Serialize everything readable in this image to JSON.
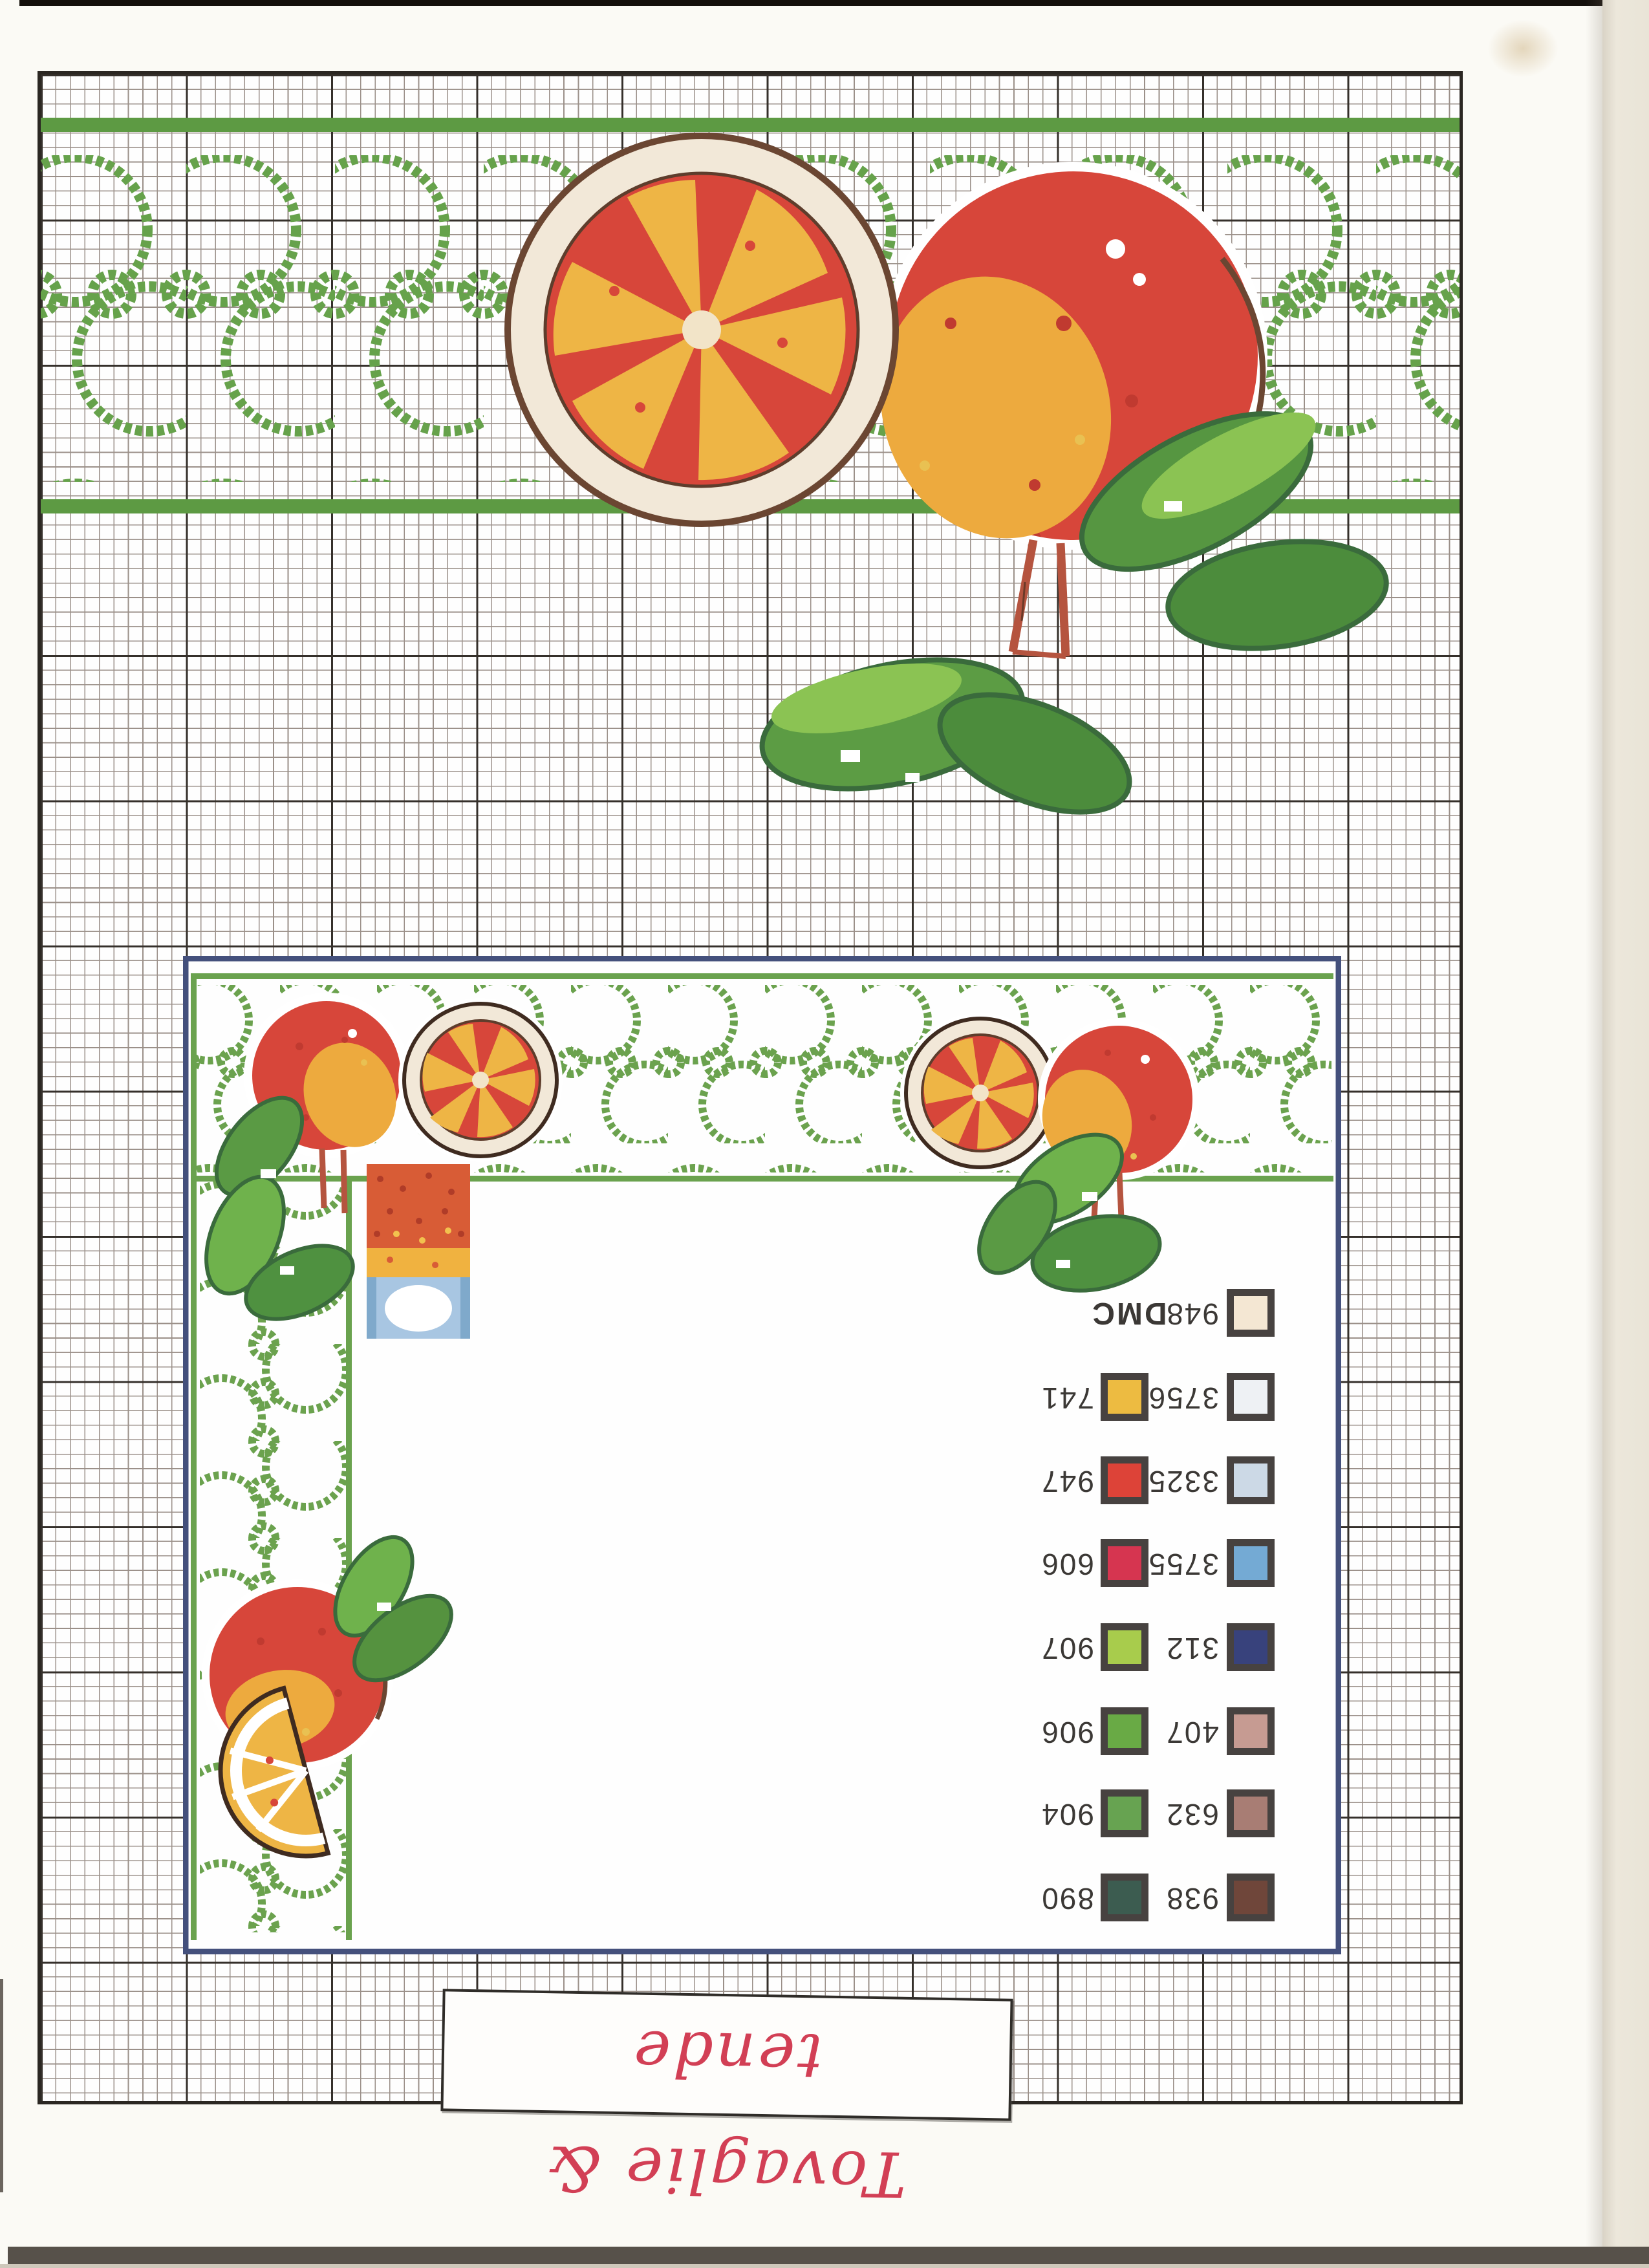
{
  "page": {
    "title": "Tovaglie & tende"
  },
  "legend": {
    "header": "DMC",
    "rows": [
      {
        "left_code": "",
        "left_color": "",
        "right_code": "948",
        "right_color": "#f4e7d3"
      },
      {
        "left_code": "741",
        "left_color": "#edbb41",
        "right_code": "3756",
        "right_color": "#eef1f4"
      },
      {
        "left_code": "947",
        "left_color": "#dd4338",
        "right_code": "3325",
        "right_color": "#ccd9e6"
      },
      {
        "left_code": "606",
        "left_color": "#d63550",
        "right_code": "3755",
        "right_color": "#74aad4"
      },
      {
        "left_code": "907",
        "left_color": "#a8cc4c",
        "right_code": "312",
        "right_color": "#38427c"
      },
      {
        "left_code": "906",
        "left_color": "#69aa45",
        "right_code": "407",
        "right_color": "#c69b92"
      },
      {
        "left_code": "904",
        "left_color": "#67a351",
        "right_code": "632",
        "right_color": "#a87d74"
      },
      {
        "left_code": "890",
        "left_color": "#3c5c50",
        "right_code": "938",
        "right_color": "#6f463a"
      }
    ]
  },
  "colors": {
    "lattice_green": "#66a24b",
    "band_green": "#5d9a43",
    "orange_red": "#d7463a",
    "orange_yellow": "#edaa3e",
    "slice_yellow": "#eeb545",
    "rind_cream": "#f2e8d8",
    "outline_brown": "#6b4632",
    "leaf_mid": "#569641",
    "leaf_light": "#8bc353",
    "leaf_dark": "#3a6b3c",
    "frame_navy": "#44507c",
    "title_red": "#d23f55"
  }
}
